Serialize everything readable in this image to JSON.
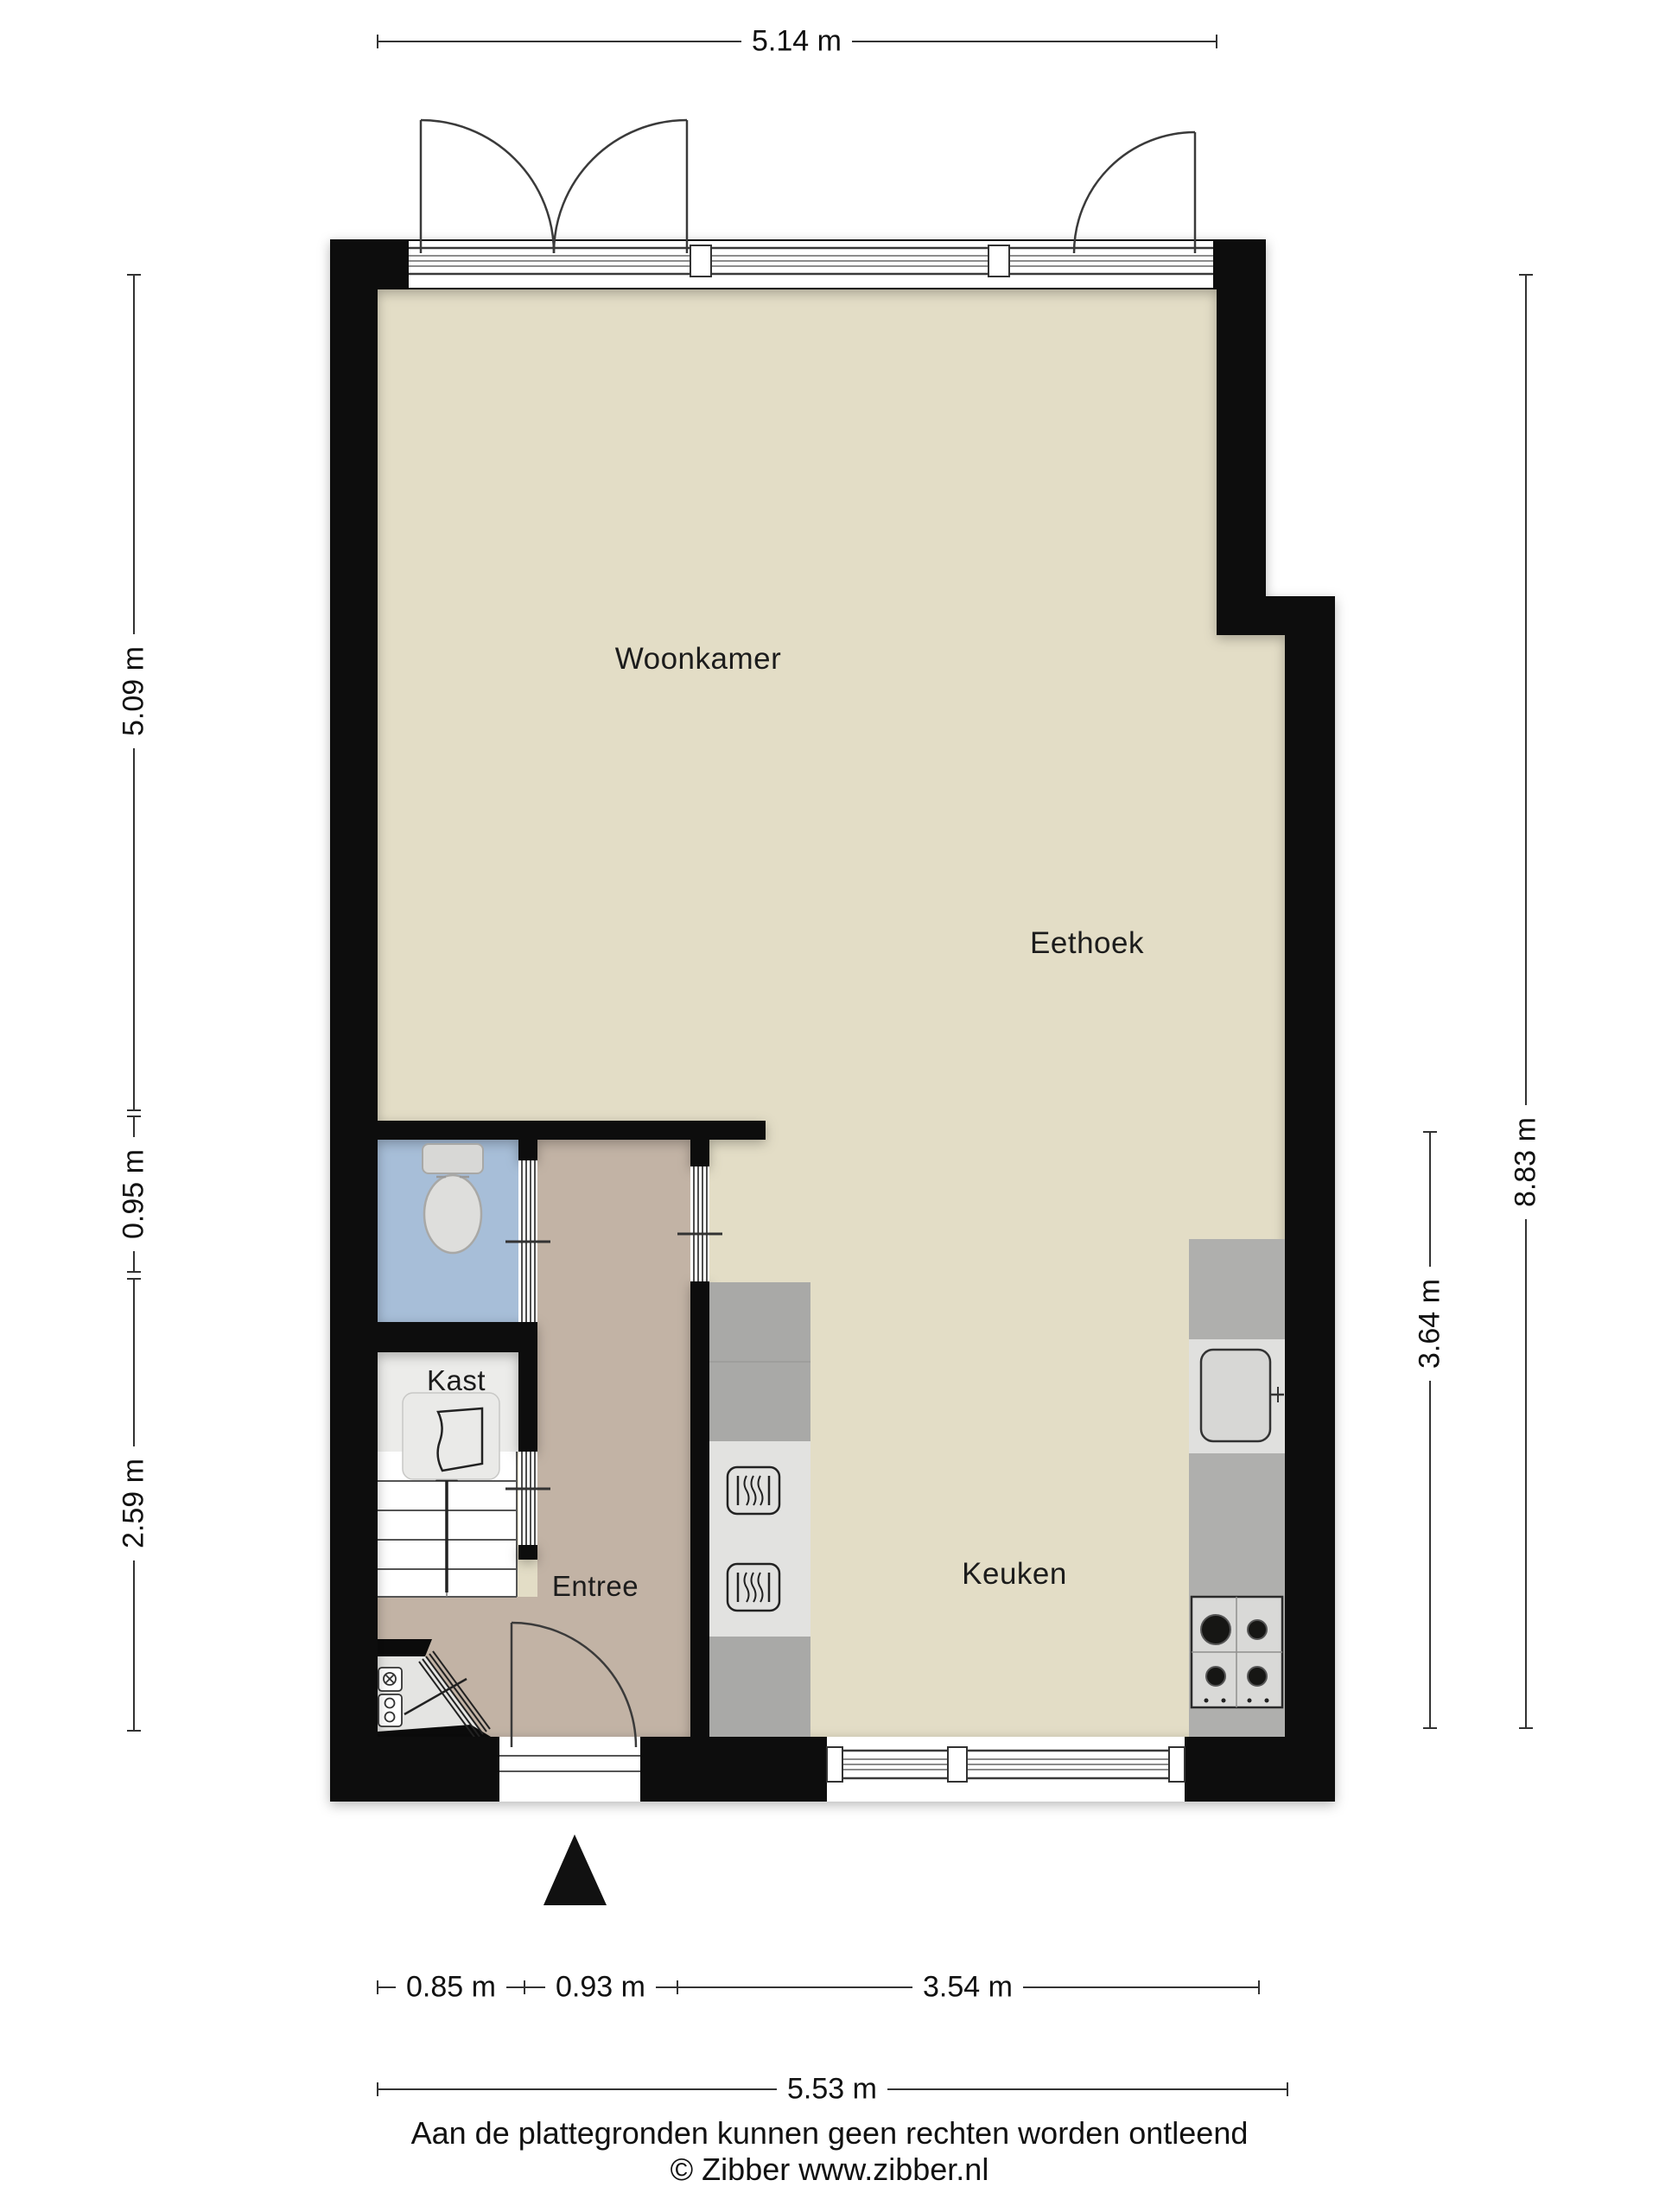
{
  "plan": {
    "rooms": [
      {
        "id": "woonkamer",
        "label": "Woonkamer"
      },
      {
        "id": "eethoek",
        "label": "Eethoek"
      },
      {
        "id": "keuken",
        "label": "Keuken"
      },
      {
        "id": "entree",
        "label": "Entree"
      },
      {
        "id": "kast",
        "label": "Kast"
      }
    ],
    "dimensions": {
      "top_width": "5.14 m",
      "bottom_width_total": "5.53 m",
      "bottom_segments": [
        "0.85 m",
        "0.93 m",
        "3.54 m"
      ],
      "left_segments": [
        "5.09 m",
        "0.95 m",
        "2.59 m"
      ],
      "right_total": "8.83 m",
      "right_kitchen": "3.64 m"
    },
    "fixtures": [
      "toilet",
      "boiler",
      "stairs",
      "oven",
      "oven",
      "sink",
      "stove",
      "meter-cupboard",
      "entrance-arrow",
      "french-doors",
      "garden-door",
      "front-door",
      "windows"
    ],
    "colors": {
      "wall": "#0b0b0b",
      "floor_main": "#E3DDC6",
      "floor_entree": "#C2B3A5",
      "floor_toilet": "#A7BED8",
      "floor_kast": "#ECECEA",
      "counter": "#AFAFAD",
      "counter_dark": "#A9A9A7",
      "appliance_panel": "#E2E2E0"
    }
  },
  "footer": {
    "disclaimer": "Aan de plattegronden kunnen geen rechten worden ontleend",
    "copyright": "© Zibber www.zibber.nl"
  }
}
